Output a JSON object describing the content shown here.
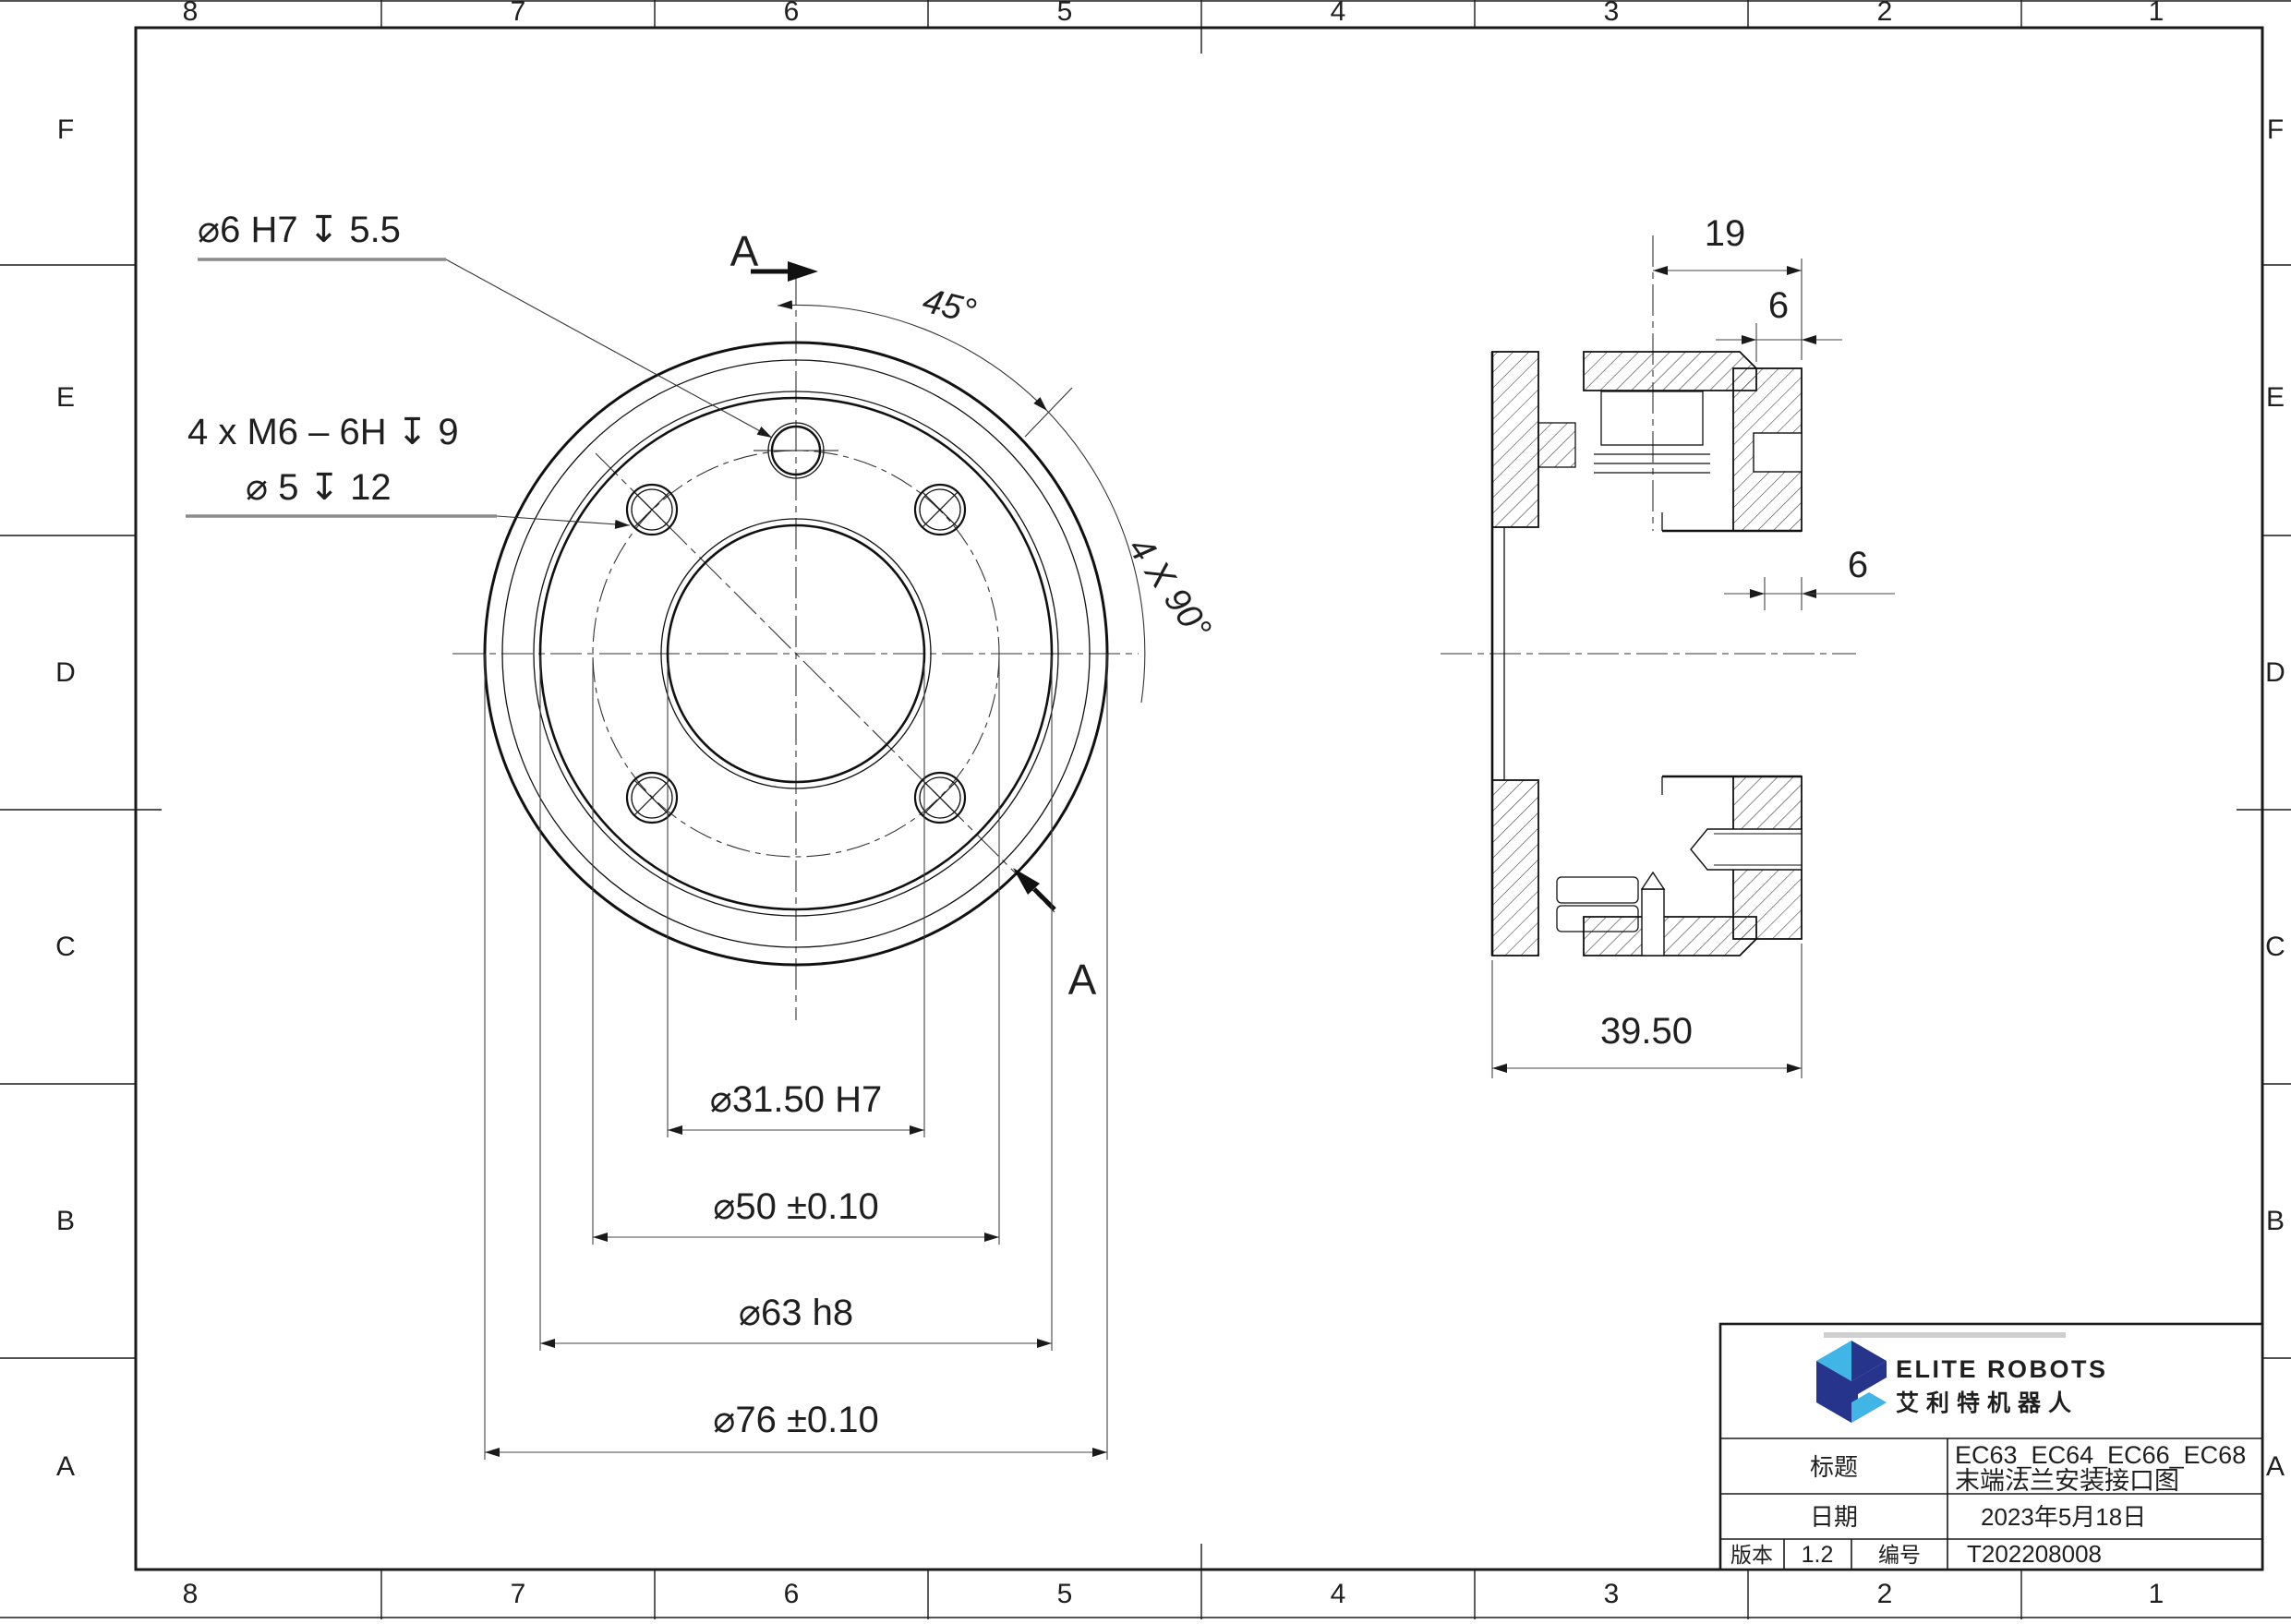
{
  "border": {
    "columns": [
      "8",
      "7",
      "6",
      "5",
      "4",
      "3",
      "2",
      "1"
    ],
    "rows": [
      "F",
      "E",
      "D",
      "C",
      "B",
      "A"
    ]
  },
  "front_view": {
    "annotation_dowel": "⌀6 H7 ↧ 5.5",
    "annotation_thread_line1": "4 x M6 – 6H ↧ 9",
    "annotation_thread_line2": "⌀ 5 ↧ 12",
    "angle_dim": "45°",
    "pattern_note": "4 X 90°",
    "section_label": "A",
    "dim_bore": "⌀31.50 H7",
    "dim_bolt_circle": "⌀50 ±0.10",
    "dim_boss": "⌀63 h8",
    "dim_outer": "⌀76 ±0.10"
  },
  "section_view": {
    "dim_depth": "19",
    "dim_lip": "6",
    "dim_step": "6",
    "dim_width": "39.50"
  },
  "title_block": {
    "brand_en": "ELITE ROBOTS",
    "brand_cn": "艾利特机器人",
    "title_label": "标题",
    "title_value_line1": "EC63_EC64_EC66_EC68",
    "title_value_line2": "末端法兰安装接口图",
    "date_label": "日期",
    "date_value": "2023年5月18日",
    "version_label": "版本",
    "version_value": "1.2",
    "number_label": "编号",
    "number_value": "T202208008"
  },
  "colors": {
    "line": "#1a1a1a",
    "navy": "#27348b",
    "light_blue": "#41b6e6"
  }
}
